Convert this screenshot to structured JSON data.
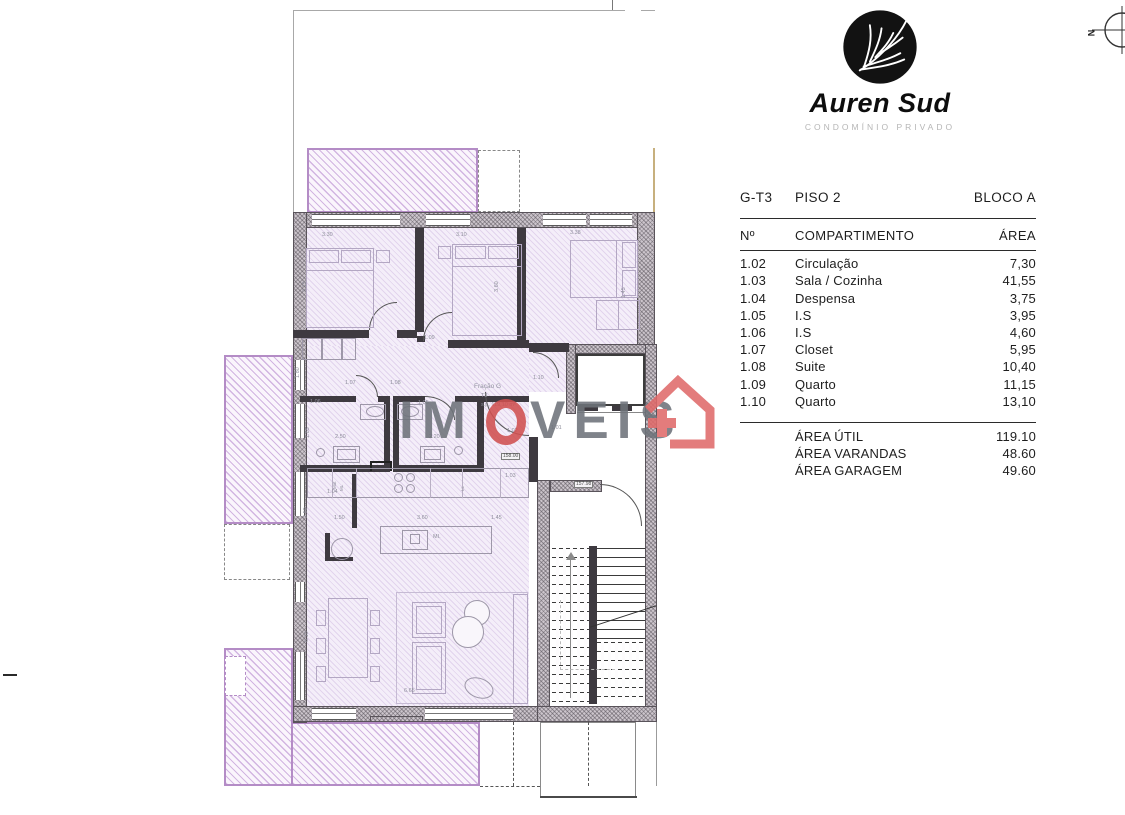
{
  "brand": {
    "name": "Auren Sud",
    "subtitle": "CONDOMÍNIO PRIVADO"
  },
  "compass": {
    "label": "N"
  },
  "watermark": {
    "part1": "IM",
    "part2": "VEIS"
  },
  "area_table": {
    "unit": "G-T3",
    "floor": "PISO 2",
    "block": "BLOCO A",
    "columns": {
      "num": "Nº",
      "name": "COMPARTIMENTO",
      "area": "ÁREA"
    },
    "rows": [
      [
        "1.02",
        "Circulação",
        "7,30"
      ],
      [
        "1.03",
        "Sala / Cozinha",
        "41,55"
      ],
      [
        "1.04",
        "Despensa",
        "3,75"
      ],
      [
        "1.05",
        "I.S",
        "3,95"
      ],
      [
        "1.06",
        "I.S",
        "4,60"
      ],
      [
        "1.07",
        "Closet",
        "5,95"
      ],
      [
        "1.08",
        "Suite",
        "10,40"
      ],
      [
        "1.09",
        "Quarto",
        "11,15"
      ],
      [
        "1.10",
        "Quarto",
        "13,10"
      ]
    ],
    "totals": [
      [
        "ÁREA ÚTIL",
        "119.10"
      ],
      [
        "ÁREA VARANDAS",
        "48.60"
      ],
      [
        "ÁREA GARAGEM",
        "49.60"
      ]
    ]
  },
  "plan": {
    "accent_purple": "#b48cc6",
    "wall_gray": "#ccc5cc",
    "watermark_red": "#d05050",
    "labels": [
      {
        "t": "3.30",
        "x": 322,
        "y": 233
      },
      {
        "t": "3.10",
        "x": 456,
        "y": 233
      },
      {
        "t": "3.38",
        "x": 570,
        "y": 231
      },
      {
        "t": "3.15",
        "x": 303,
        "y": 292,
        "r": 1
      },
      {
        "t": "3.60",
        "x": 495,
        "y": 292,
        "r": 1
      },
      {
        "t": "1.45",
        "x": 622,
        "y": 298,
        "r": 1
      },
      {
        "t": "1.09",
        "x": 424,
        "y": 336
      },
      {
        "t": "1.80",
        "x": 296,
        "y": 378,
        "r": 1
      },
      {
        "t": "1.07",
        "x": 345,
        "y": 381
      },
      {
        "t": "1.08",
        "x": 390,
        "y": 381
      },
      {
        "t": "1.10",
        "x": 533,
        "y": 376
      },
      {
        "t": "Fração G",
        "x": 474,
        "y": 384,
        "s": 6.5,
        "c": "#9292a0"
      },
      {
        "t": "T3",
        "x": 481,
        "y": 394
      },
      {
        "t": "s.p. 119,10 m²",
        "x": 481,
        "y": 403
      },
      {
        "t": "1.06",
        "x": 310,
        "y": 400
      },
      {
        "t": "1.05",
        "x": 418,
        "y": 401
      },
      {
        "t": "1.85",
        "x": 306,
        "y": 438,
        "r": 1
      },
      {
        "t": "2.50",
        "x": 335,
        "y": 435
      },
      {
        "t": "2.20",
        "x": 429,
        "y": 435
      },
      {
        "t": "1.02",
        "x": 507,
        "y": 429
      },
      {
        "t": "1.01",
        "x": 551,
        "y": 426
      },
      {
        "t": "158.00",
        "x": 501,
        "y": 453,
        "b": 1
      },
      {
        "t": "1.03",
        "x": 505,
        "y": 474
      },
      {
        "t": "157.98",
        "x": 574,
        "y": 481,
        "b": 1
      },
      {
        "t": "1.04",
        "x": 327,
        "y": 490
      },
      {
        "t": "Mat",
        "x": 333,
        "y": 489,
        "r": 1,
        "s": 4.5
      },
      {
        "t": "ML",
        "x": 340,
        "y": 491,
        "r": 1,
        "s": 4.5
      },
      {
        "t": "LL",
        "x": 461,
        "y": 491,
        "r": 1,
        "s": 4.5
      },
      {
        "t": "2.50",
        "x": 304,
        "y": 518,
        "r": 1
      },
      {
        "t": "1.50",
        "x": 334,
        "y": 516
      },
      {
        "t": "3.60",
        "x": 417,
        "y": 516
      },
      {
        "t": "1.45",
        "x": 491,
        "y": 516
      },
      {
        "t": "MI.",
        "x": 433,
        "y": 535,
        "c": "#8f8f9c"
      },
      {
        "t": "6.10",
        "x": 305,
        "y": 642,
        "r": 1
      },
      {
        "t": "6.65",
        "x": 404,
        "y": 689
      }
    ]
  }
}
